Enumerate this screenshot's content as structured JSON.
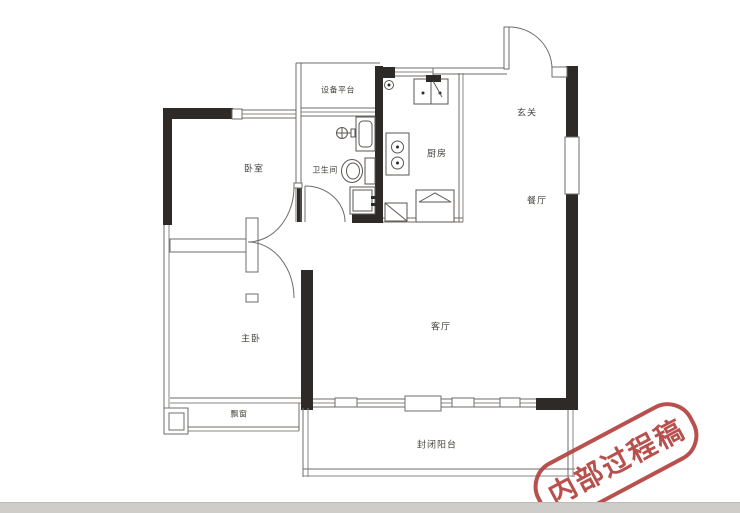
{
  "meta": {
    "kind": "apartment-floor-plan"
  },
  "colors": {
    "wall": "#2d2a28",
    "thin_line": "#6f6c69",
    "label": "#45433e",
    "stamp_red": "#b2423e",
    "photo_edge": "#cfcdca",
    "background": "#ffffff"
  },
  "rooms": [
    {
      "id": "bedroom",
      "label": "卧室"
    },
    {
      "id": "equipment-platform",
      "label": "设备平台"
    },
    {
      "id": "bathroom",
      "label": "卫生间"
    },
    {
      "id": "kitchen",
      "label": "厨房"
    },
    {
      "id": "entry",
      "label": "玄关"
    },
    {
      "id": "dining",
      "label": "餐厅"
    },
    {
      "id": "living",
      "label": "客厅"
    },
    {
      "id": "master-bedroom",
      "label": "主卧"
    },
    {
      "id": "bay-window",
      "label": "飘窗"
    },
    {
      "id": "balcony",
      "label": "封闭阳台"
    }
  ],
  "fixtures": [
    "kitchen-sink",
    "kitchen-stove",
    "kitchen-fridge",
    "kitchen-corner-cabinet",
    "bathroom-basin",
    "bathroom-toilet",
    "bathroom-shower",
    "gas-meter"
  ],
  "watermark": {
    "text": "内部过程稿"
  }
}
